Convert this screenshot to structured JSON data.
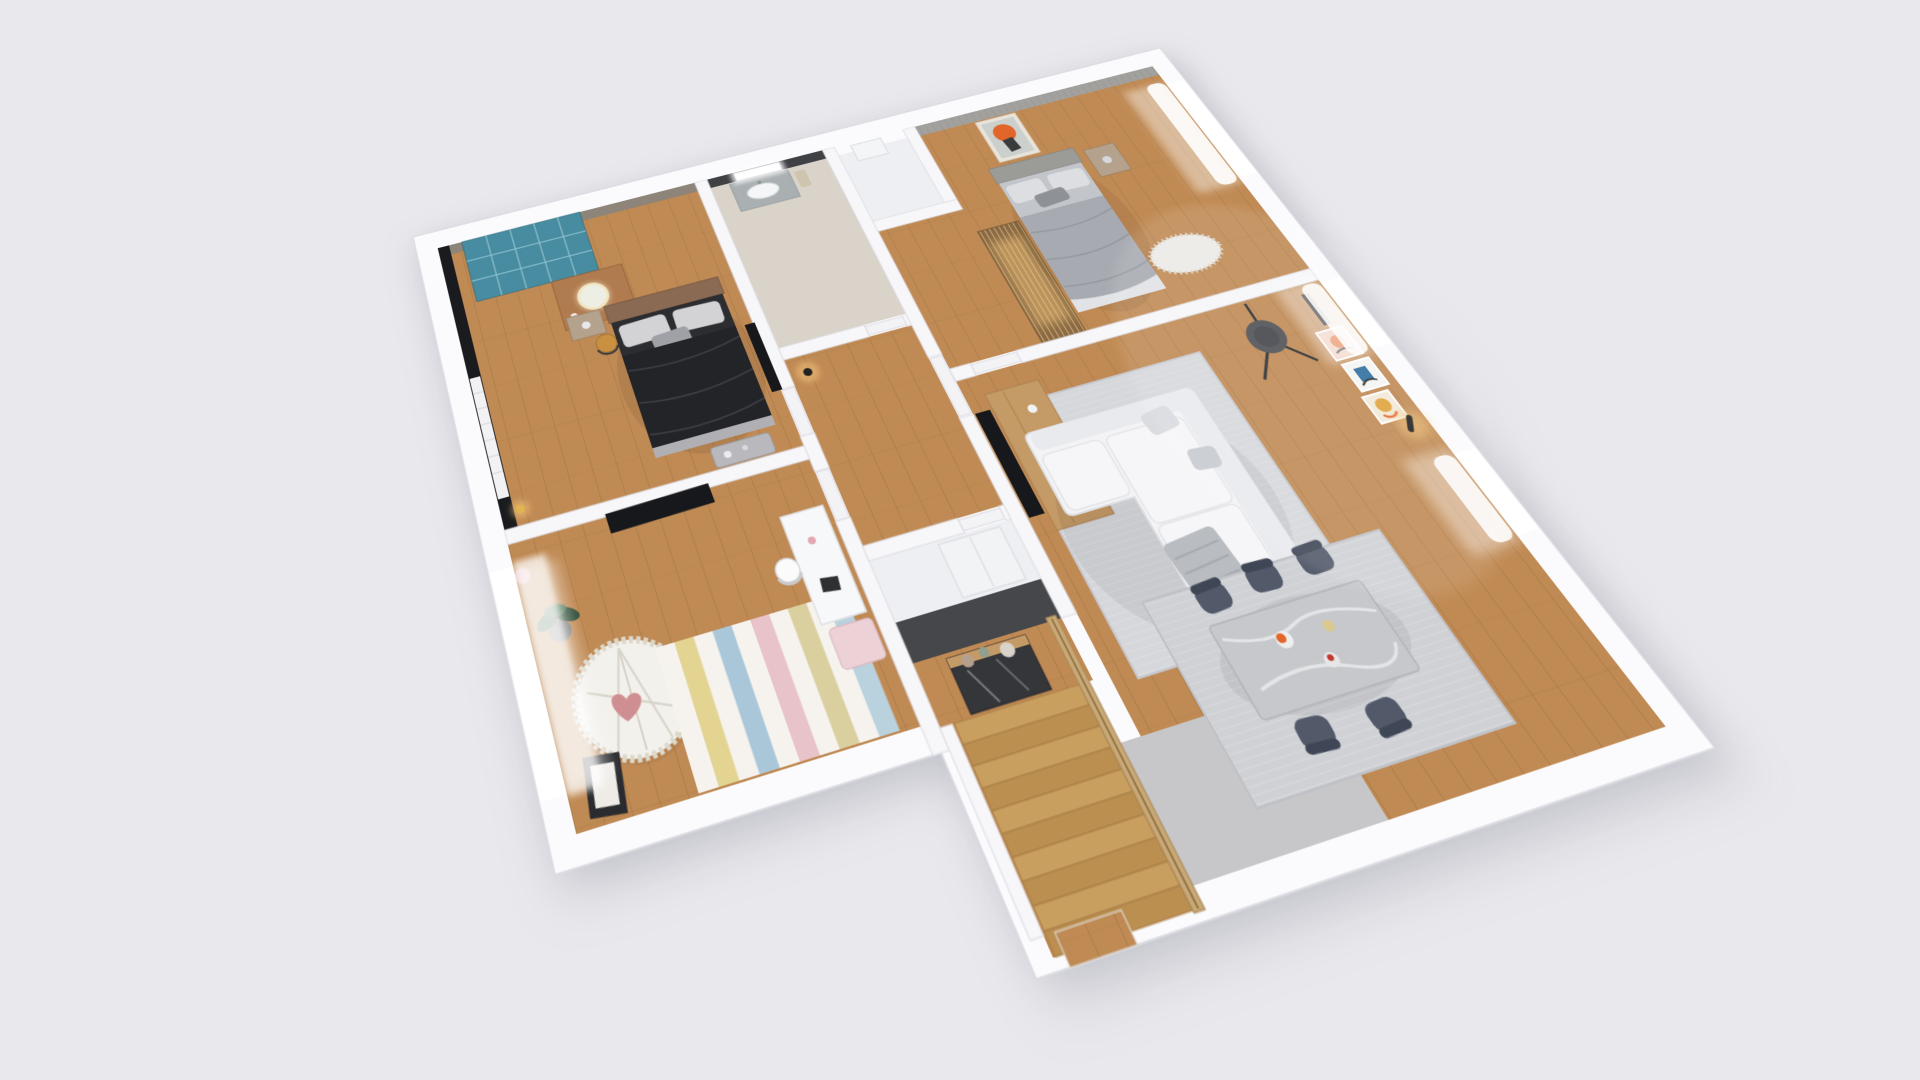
{
  "scene": {
    "title": "3D isometric dollhouse rendering of a furnished apartment floor plan on a light gray background",
    "background": "#e9e9ed"
  },
  "colors": {
    "background": "#e9e9ed",
    "wallOuter": "#fbfbfd",
    "wallInner": "#f7f7fa",
    "wallEdge": "#dcdce4",
    "darkWall": "#46474b",
    "blackWall": "#1a1b1e",
    "taupeWall": "#8d8579",
    "accentWallB2": "#a3a19d",
    "bathWallDark": "#3f4145",
    "wood": "#c08a54",
    "woodLine": "#a87844",
    "bathFloor": "#d9d3c9",
    "whiteFloor": "#edeff2",
    "landing": "#c7c7c9",
    "teal": "#2e7d94",
    "tealCell": "#8ec4d2",
    "deskWood": "#b07b4e",
    "mirrorRing": "#e8d9b0",
    "chairMustard": "#c89040",
    "headboard": "#8a6a52",
    "bedDark": "#2b2d31",
    "duvetDark": "#222428",
    "pillowLight": "#d3d3d6",
    "pillowMid": "#9fa1a6",
    "benchGray": "#b9b9bd",
    "nightstand": "#b5a28c",
    "tv": "#17181b",
    "plantGreen": "#3c6045",
    "plantPot": "#77787a",
    "matWhite": "#f3f1ec",
    "matEdge": "#ddd8cc",
    "heartPink": "#cf8e92",
    "deskWhite": "#f7f8f9",
    "benchPink": "#ecd1d6",
    "frameDark": "#2a2b2e",
    "vanity": "#aab0b2",
    "sink": "#f4f6f7",
    "dresserWhite": "#f2f3f5",
    "consoleDark": "#35363a",
    "consoleWood": "#c49a66",
    "sconce": "#222222",
    "glowWarm": "#f6c77e",
    "bed2Mattress": "#c2c5ca",
    "bed2Blanket": "#a7abb1",
    "bed2Pillow": "#dcdee2",
    "slatWood": "#caa96f",
    "slatDark": "#8a6a45",
    "rugFluffy": "#eceae6",
    "sofaWhite": "#f3f3f5",
    "sofaShadow": "#d9dadf",
    "throwGray": "#b9bcc0",
    "rugLiving": "#d6d7db",
    "rugDining": "#cfd1d5",
    "lampDark": "#4e5055",
    "tableMarble": "#c6c8cc",
    "marbleVein": "#e6e8ea",
    "chairSlate": "#525a6a",
    "artOrange": "#e2662a",
    "artPink": "#eecdbd",
    "artBlue": "#2e6e9e",
    "artYellow": "#e0a33c",
    "railWood": "#c8a876",
    "windowLight": "#ffffff"
  },
  "rooms": [
    {
      "id": "master-bedroom",
      "name": "Master Bedroom",
      "floor": "wood",
      "features": [
        "black accent wall",
        "teal glass-grid wardrobe",
        "wood vanity desk with round lit mirror",
        "mustard chair",
        "double bed with dark bedding",
        "gray bench",
        "wall TV",
        "louver door",
        "brass floor lamp"
      ]
    },
    {
      "id": "kids-room",
      "name": "Kids Room",
      "floor": "wood",
      "features": [
        "wall TV",
        "potted plant",
        "round ruffled play mat with heart pillow",
        "striped pastel rug",
        "white desk",
        "pink bench",
        "leaning black frame",
        "window with sheer curtain",
        "pink wall decor"
      ]
    },
    {
      "id": "bathroom",
      "name": "Bathroom",
      "floor": "stone tile",
      "features": [
        "charcoal accent wall",
        "backlit mirror",
        "vanity with sink"
      ]
    },
    {
      "id": "hallway",
      "name": "Hallway",
      "floor": "wood",
      "features": [
        "white doors",
        "black wall sconce"
      ]
    },
    {
      "id": "storage-closet",
      "name": "Storage Closet",
      "floor": "white",
      "features": [
        "white dresser",
        "white door"
      ]
    },
    {
      "id": "entry",
      "name": "Entry Hall",
      "floor": "wood",
      "features": [
        "dark feature wall",
        "mirrored console with wood top",
        "decorative vases"
      ]
    },
    {
      "id": "small-closet",
      "name": "Small Closet",
      "floor": "white",
      "features": [
        "white storage box"
      ]
    },
    {
      "id": "bedroom-2",
      "name": "Bedroom 2",
      "floor": "wood",
      "features": [
        "striped gray accent wall",
        "orange portrait artwork",
        "double bed with gray bedding",
        "nightstand with lamp",
        "wood slat wardrobe with warm light",
        "fluffy rug",
        "window with sheer curtains"
      ]
    },
    {
      "id": "living-room",
      "name": "Living Room",
      "floor": "wood",
      "features": [
        "wall TV",
        "wood media console",
        "black tripod floor lamp",
        "white L-shaped sectional sofa",
        "gray area rug",
        "gallery wall with abstract art",
        "two windows with curtains",
        "black wall sconce"
      ]
    },
    {
      "id": "dining-area",
      "name": "Dining Area",
      "floor": "wood",
      "features": [
        "gray marble dining table with food",
        "five slate dining chairs",
        "gray flatweave rug"
      ]
    },
    {
      "id": "staircase",
      "name": "Staircase",
      "floor": "wood",
      "features": [
        "wood treads",
        "wood slat railing",
        "gray landing",
        "exit doorway in outer wall"
      ]
    }
  ],
  "kids_room": {
    "rug_stripes": [
      "#f6f3ef",
      "#e3d492",
      "#f6f3ef",
      "#a9c7d8",
      "#f6f3ef",
      "#e8c3c9",
      "#f6f3ef",
      "#d9cf9f",
      "#f6f3ef",
      "#b9d2de"
    ]
  },
  "staircase": {
    "tread_colors": [
      "#c99f60",
      "#bb8f50"
    ]
  }
}
